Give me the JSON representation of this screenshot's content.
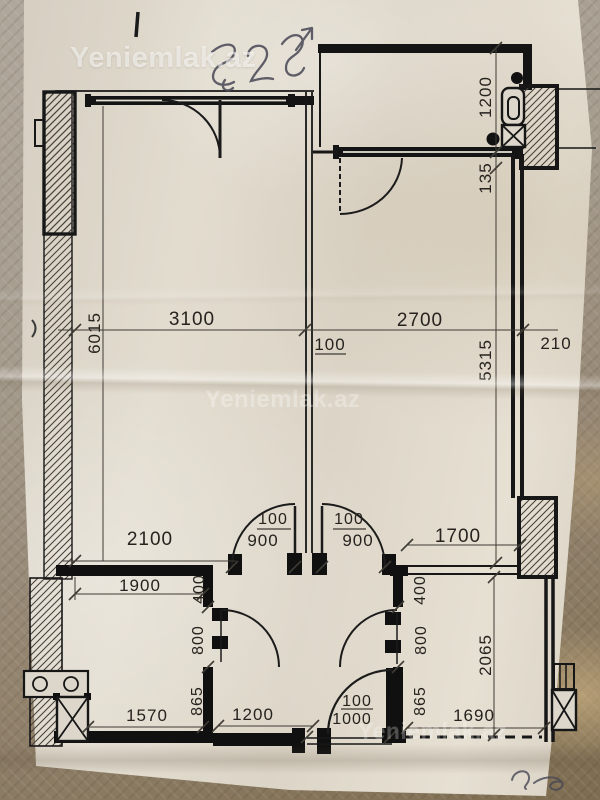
{
  "watermarks": {
    "top": "Yeniemlak.az",
    "middle": "Yeniemlak.az",
    "bottom": "Yeniemlak.az"
  },
  "handwriting": {
    "top_note": "52",
    "bottom_note": "cq"
  },
  "plan": {
    "labels": {
      "left_room_width": "3100",
      "center_wall": "100",
      "right_room_width": "2700",
      "right_wall_thickness": "210",
      "left_room_depth": "6015",
      "right_room_depth": "5315",
      "balcony_depth": "1200",
      "balcony_ledge": "135",
      "hall_span_left": "2100",
      "left_door_jamb": "100",
      "left_door_width": "900",
      "right_door_jamb": "100",
      "right_door_width": "900",
      "hall_span_right": "1700",
      "bath_width_top": "1900",
      "left_partition_top": "400",
      "left_partition_door": "800",
      "left_partition_bottom": "865",
      "bath_width_bottom": "1570",
      "hall_width_bottom": "1200",
      "entry_door_jamb": "100",
      "entry_door_width": "1000",
      "right_partition_top": "400",
      "right_partition_door": "800",
      "right_partition_bottom": "865",
      "kitchen_depth": "2065",
      "kitchen_width_bottom": "1690"
    }
  }
}
